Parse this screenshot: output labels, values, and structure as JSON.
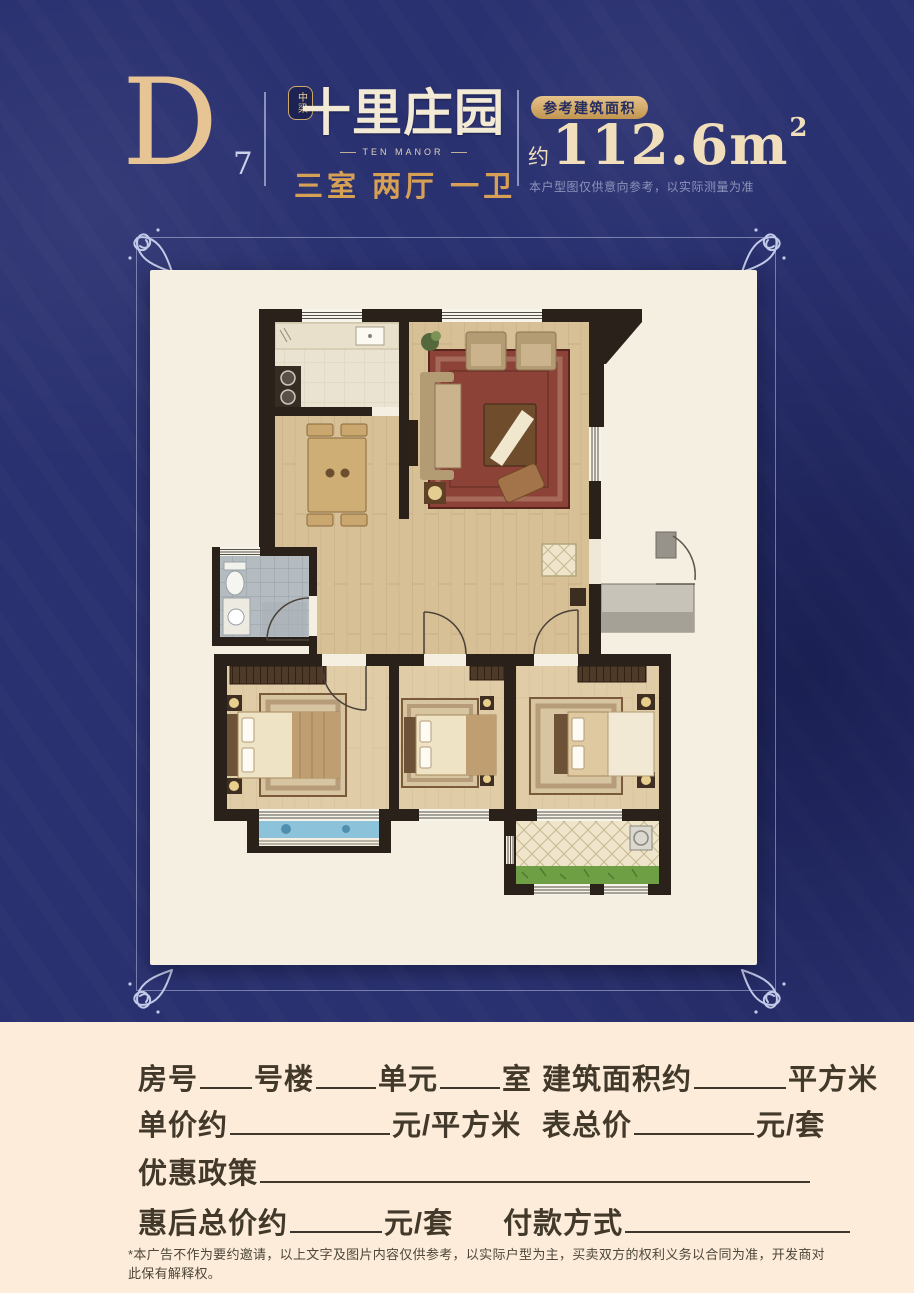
{
  "header": {
    "unit_letter": "D",
    "unit_number": "7",
    "brand_badge": "中梁",
    "brand_name": "十里庄园",
    "brand_name_en": "TEN MANOR",
    "layout_summary": "三室 两厅 一卫",
    "area_badge_label": "参考建筑面积",
    "area_prefix": "约",
    "area_value": "112.6m",
    "area_superscript": "2",
    "area_disclaimer": "本户型图仅供意向参考，以实际测量为准"
  },
  "form": {
    "room_label": "房号",
    "building_label": "号楼",
    "unit_label": "单元",
    "suite_label": "室",
    "area_label": "建筑面积约",
    "area_unit": "平方米",
    "unit_price_label": "单价约",
    "unit_price_unit": "元/平方米",
    "list_price_label": "表总价",
    "list_price_unit": "元/套",
    "discount_label": "优惠政策",
    "final_price_label": "惠后总价约",
    "final_price_unit": "元/套",
    "payment_label": "付款方式",
    "disclaimer": "*本广告不作为要约邀请，以上文字及图片内容仅供参考，以实际户型为主，买卖双方的权利义务以合同为准，开发商对此保有解释权。"
  },
  "colors": {
    "background_navy": "#2A3170",
    "accent_gold": "#D9AE6E",
    "logo_cream": "#F3EAD6",
    "panel_cream": "#F5EFE2",
    "bottom_cream": "#FCECD9",
    "form_text": "#42392B",
    "wall_dark": "#2A221A"
  }
}
